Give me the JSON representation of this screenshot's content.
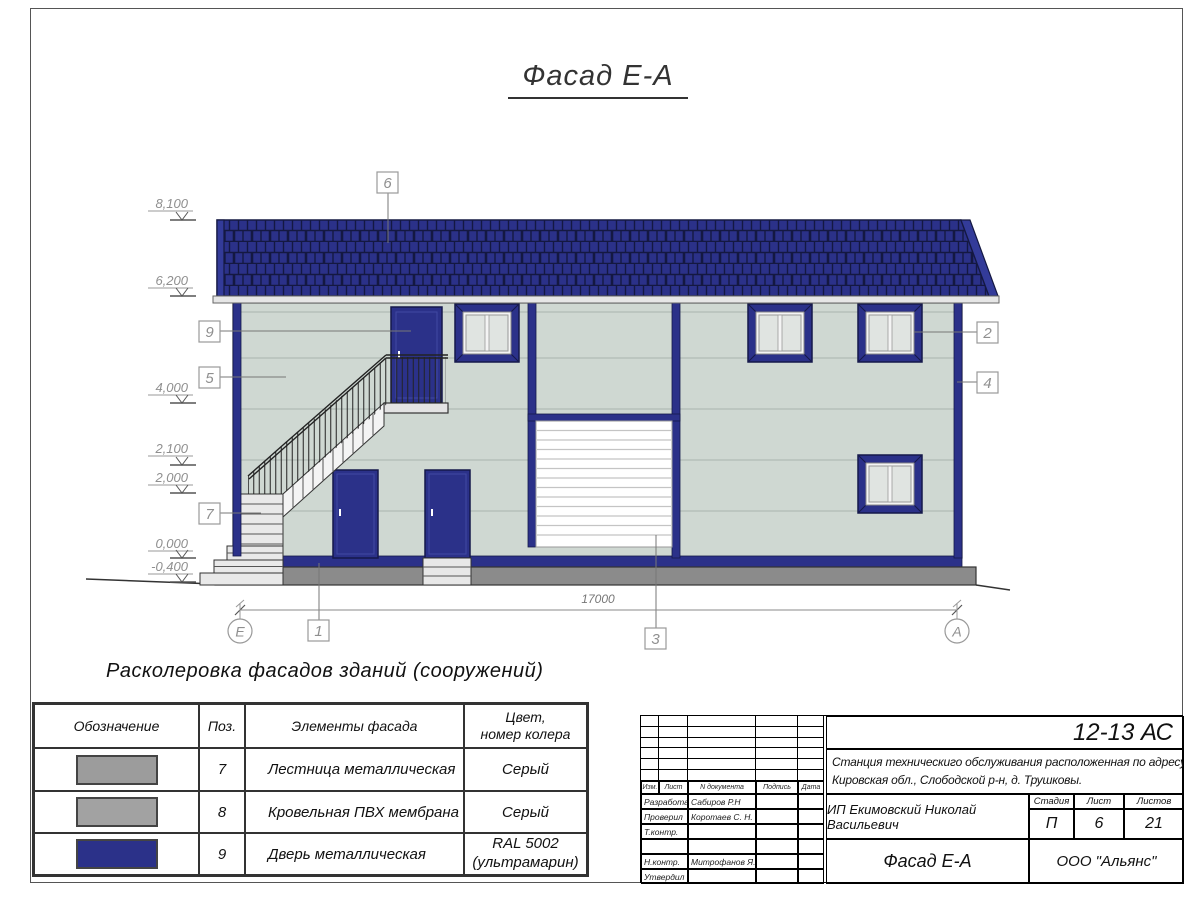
{
  "page": {
    "title": "Фасад Е-А"
  },
  "drawing": {
    "levels": [
      "8,100",
      "6,200",
      "4,000",
      "2,100",
      "2,000",
      "0,000",
      "-0,400"
    ],
    "callouts": {
      "c1": "1",
      "c2": "2",
      "c3": "3",
      "c4": "4",
      "c5": "5",
      "c6": "6",
      "c7": "7",
      "c9": "9"
    },
    "dimension_total": "17000",
    "axis_left": "Е",
    "axis_right": "А",
    "colors": {
      "facade_blue": "#2b3189",
      "wall": "#cfd8d2",
      "plinth_gray": "#8b8b8b"
    }
  },
  "legend": {
    "heading": "Расколеровка фасадов зданий (сооружений)",
    "columns": [
      "Обозначение",
      "Поз.",
      "Элементы фасада",
      "Цвет,\nномер колера"
    ],
    "rows": [
      {
        "pos": "7",
        "element": "Лестница металлическая",
        "color": "Серый",
        "swatch": "#9c9c9c"
      },
      {
        "pos": "8",
        "element": "Кровельная ПВХ мембрана",
        "color": "Серый",
        "swatch": "#a2a2a2"
      },
      {
        "pos": "9",
        "element": "Дверь металлическая",
        "color": "RAL 5002\n(ультрамарин)",
        "swatch": "#2b3189"
      }
    ]
  },
  "title_block": {
    "doc_number": "12-13 АС",
    "object_line1": "Станция техническиго обслуживания расположенная по адресу",
    "object_line2": "Кировская обл., Слободской р-н, д. Трушковы.",
    "client": "ИП Екимовский Николай Васильевич",
    "drawing_title": "Фасад Е-А",
    "company": "ООО \"Альянс\"",
    "stage_label": "Стадия",
    "sheet_label": "Лист",
    "sheets_label": "Листов",
    "stage": "П",
    "sheet": "6",
    "sheets": "21",
    "rev_header": [
      "Изм.",
      "Лист",
      "N документа",
      "Подпись",
      "Дата"
    ],
    "roles": [
      {
        "label": "Разработал",
        "name": "Сабиров Р.Н"
      },
      {
        "label": "Проверил",
        "name": "Коротаев С. Н."
      },
      {
        "label": "Т.контр.",
        "name": ""
      },
      {
        "label": "",
        "name": ""
      },
      {
        "label": "Н.контр.",
        "name": "Митрофанов Я. А."
      },
      {
        "label": "Утвердил",
        "name": ""
      }
    ]
  }
}
